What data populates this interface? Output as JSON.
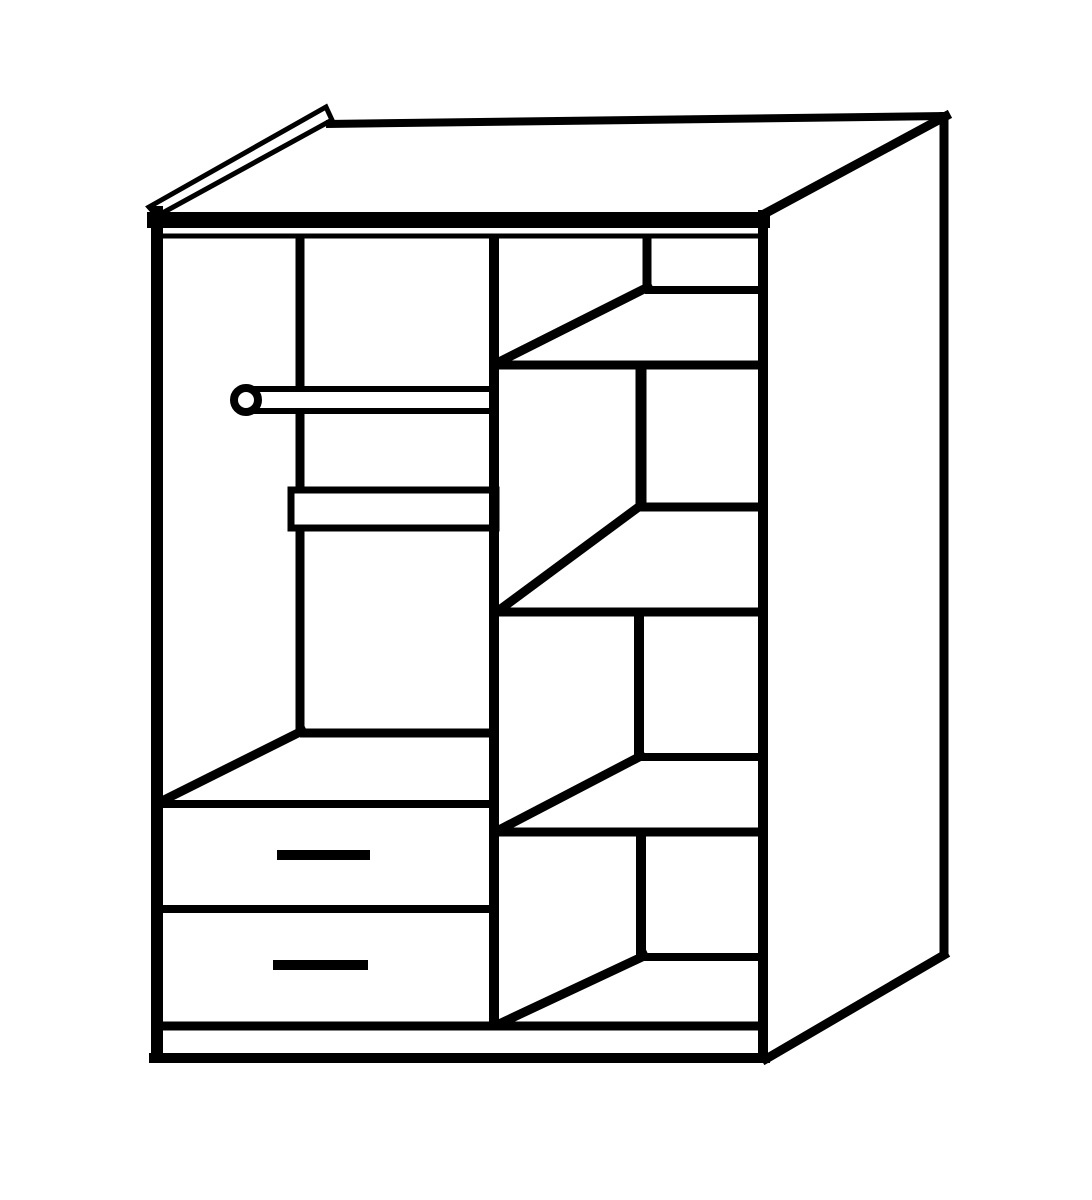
{
  "canvas": {
    "width": 1092,
    "height": 1200,
    "background_color": "#ffffff",
    "line_color": "#000000"
  },
  "diagram": {
    "kind": "wardrobe-interior-line-drawing",
    "elements": [
      {
        "name": "interior-back-left-corner-line",
        "shape": "line",
        "points": [
          300,
          238,
          300,
          733
        ],
        "width": 9,
        "cap": "butt"
      },
      {
        "name": "hanging-rail-bar",
        "shape": "rect",
        "x": 248,
        "y": 389,
        "w": 248,
        "h": 22,
        "stroke_width": 6,
        "fill": "#ffffff"
      },
      {
        "name": "hanging-rail-end-cap",
        "shape": "circle",
        "cx": 246,
        "cy": 400,
        "r": 12,
        "stroke_width": 8,
        "fill": "#ffffff"
      },
      {
        "name": "left-column-shelf-board",
        "shape": "rect",
        "x": 291,
        "y": 490,
        "w": 205,
        "h": 38,
        "stroke_width": 7,
        "fill": "#ffffff"
      },
      {
        "name": "left-column-floor-back-edge",
        "shape": "line",
        "points": [
          300,
          733,
          494,
          733
        ],
        "width": 9,
        "cap": "butt"
      },
      {
        "name": "left-column-floor-left-edge",
        "shape": "line",
        "points": [
          302,
          731,
          158,
          803
        ],
        "width": 9,
        "cap": "square"
      },
      {
        "name": "drawer-section-top-edge",
        "shape": "line",
        "points": [
          157,
          804,
          494,
          804
        ],
        "width": 8,
        "cap": "butt"
      },
      {
        "name": "drawer-divider-edge",
        "shape": "line",
        "points": [
          160,
          909,
          492,
          909
        ],
        "width": 8,
        "cap": "butt"
      },
      {
        "name": "drawer-1-handle",
        "shape": "line",
        "points": [
          277,
          855,
          370,
          855
        ],
        "width": 10,
        "cap": "butt"
      },
      {
        "name": "drawer-2-handle",
        "shape": "line",
        "points": [
          273,
          965,
          368,
          965
        ],
        "width": 10,
        "cap": "butt"
      },
      {
        "name": "center-divider-panel",
        "shape": "line",
        "points": [
          494,
          238,
          494,
          1030
        ],
        "width": 10,
        "cap": "butt"
      },
      {
        "name": "compartment-1-back-corner",
        "shape": "line",
        "points": [
          647,
          238,
          647,
          289
        ],
        "width": 9,
        "cap": "butt"
      },
      {
        "name": "shelf-1-back-edge",
        "shape": "line",
        "points": [
          645,
          290,
          762,
          290
        ],
        "width": 8,
        "cap": "butt"
      },
      {
        "name": "shelf-1-left-edge",
        "shape": "line",
        "points": [
          648,
          287,
          497,
          363
        ],
        "width": 9,
        "cap": "square"
      },
      {
        "name": "shelf-1-front-edge",
        "shape": "line",
        "points": [
          494,
          365,
          766,
          365
        ],
        "width": 9,
        "cap": "butt"
      },
      {
        "name": "compartment-2-back-corner",
        "shape": "line",
        "points": [
          641,
          369,
          641,
          508
        ],
        "width": 11,
        "cap": "butt"
      },
      {
        "name": "shelf-2-back-edge",
        "shape": "line",
        "points": [
          639,
          507,
          762,
          507
        ],
        "width": 9,
        "cap": "butt"
      },
      {
        "name": "shelf-2-left-edge",
        "shape": "line",
        "points": [
          640,
          506,
          498,
          611
        ],
        "width": 9,
        "cap": "square"
      },
      {
        "name": "shelf-2-front-edge",
        "shape": "line",
        "points": [
          494,
          612,
          766,
          612
        ],
        "width": 9,
        "cap": "butt"
      },
      {
        "name": "compartment-3-back-corner",
        "shape": "line",
        "points": [
          639,
          614,
          639,
          757
        ],
        "width": 10,
        "cap": "butt"
      },
      {
        "name": "shelf-3-back-edge",
        "shape": "line",
        "points": [
          637,
          757,
          762,
          757
        ],
        "width": 8,
        "cap": "butt"
      },
      {
        "name": "shelf-3-left-edge",
        "shape": "line",
        "points": [
          641,
          756,
          497,
          831
        ],
        "width": 9,
        "cap": "square"
      },
      {
        "name": "shelf-3-front-edge",
        "shape": "line",
        "points": [
          494,
          832,
          766,
          832
        ],
        "width": 9,
        "cap": "butt"
      },
      {
        "name": "compartment-4-back-corner",
        "shape": "line",
        "points": [
          641,
          834,
          641,
          956
        ],
        "width": 10,
        "cap": "butt"
      },
      {
        "name": "shelf-4-back-edge",
        "shape": "line",
        "points": [
          639,
          957,
          762,
          957
        ],
        "width": 8,
        "cap": "butt"
      },
      {
        "name": "shelf-4-left-edge",
        "shape": "line",
        "points": [
          644,
          956,
          499,
          1024
        ],
        "width": 9,
        "cap": "square"
      },
      {
        "name": "base-top-edge",
        "shape": "line",
        "points": [
          157,
          1026,
          763,
          1026
        ],
        "width": 9,
        "cap": "butt"
      },
      {
        "name": "base-bottom-edge",
        "shape": "line",
        "points": [
          149,
          1058,
          770,
          1058
        ],
        "width": 10,
        "cap": "butt"
      },
      {
        "name": "top-panel-front-edge",
        "shape": "line",
        "points": [
          147,
          220,
          770,
          220
        ],
        "width": 16,
        "cap": "butt"
      },
      {
        "name": "top-panel-front-inner-line",
        "shape": "line",
        "points": [
          160,
          236,
          763,
          236
        ],
        "width": 5,
        "cap": "butt"
      },
      {
        "name": "top-panel-left-edge-wedge",
        "shape": "polygon",
        "points": [
          149,
          207,
          326,
          107,
          332,
          120,
          157,
          216
        ],
        "stroke_width": 5,
        "fill": "#ffffff"
      },
      {
        "name": "top-panel-back-edge",
        "shape": "line",
        "points": [
          326,
          124,
          946,
          116
        ],
        "width": 8,
        "cap": "butt"
      },
      {
        "name": "left-side-panel-edge",
        "shape": "line",
        "points": [
          157,
          206,
          157,
          1062
        ],
        "width": 12,
        "cap": "butt"
      },
      {
        "name": "right-front-edge",
        "shape": "line",
        "points": [
          763,
          210,
          763,
          1062
        ],
        "width": 10,
        "cap": "butt"
      },
      {
        "name": "side-panel-top-edge",
        "shape": "line",
        "points": [
          766,
          213,
          946,
          116
        ],
        "width": 9,
        "cap": "square"
      },
      {
        "name": "right-back-edge",
        "shape": "line",
        "points": [
          944,
          112,
          944,
          957
        ],
        "width": 9,
        "cap": "butt"
      },
      {
        "name": "side-panel-bottom-edge",
        "shape": "line",
        "points": [
          766,
          1059,
          944,
          955
        ],
        "width": 9,
        "cap": "square"
      }
    ]
  }
}
